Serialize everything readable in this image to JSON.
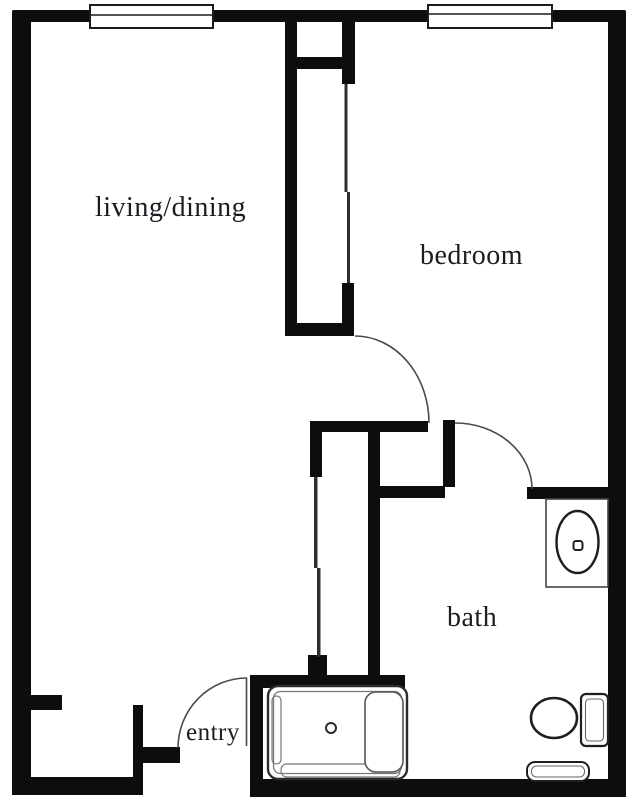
{
  "plan": {
    "rooms": [
      {
        "id": "living-dining",
        "label": "living/dining"
      },
      {
        "id": "bedroom",
        "label": "bedroom"
      },
      {
        "id": "bath",
        "label": "bath"
      },
      {
        "id": "entry",
        "label": "entry"
      }
    ],
    "fixtures": [
      "window-icon",
      "window-icon",
      "bedroom-closet-sliding-doors-icon",
      "hall-closet-sliding-doors-icon",
      "bedroom-door-swing-icon",
      "bath-door-swing-icon",
      "entry-door-swing-icon",
      "bathtub-icon",
      "sink-icon",
      "toilet-icon",
      "bath-mat-icon"
    ],
    "colors": {
      "wall": "#0d0d0f",
      "thin_line": "#4a4a4a",
      "fixture_outline": "#2b2b2b",
      "fixture_detail": "#777777",
      "background": "#ffffff",
      "text": "#1c1c22"
    }
  }
}
